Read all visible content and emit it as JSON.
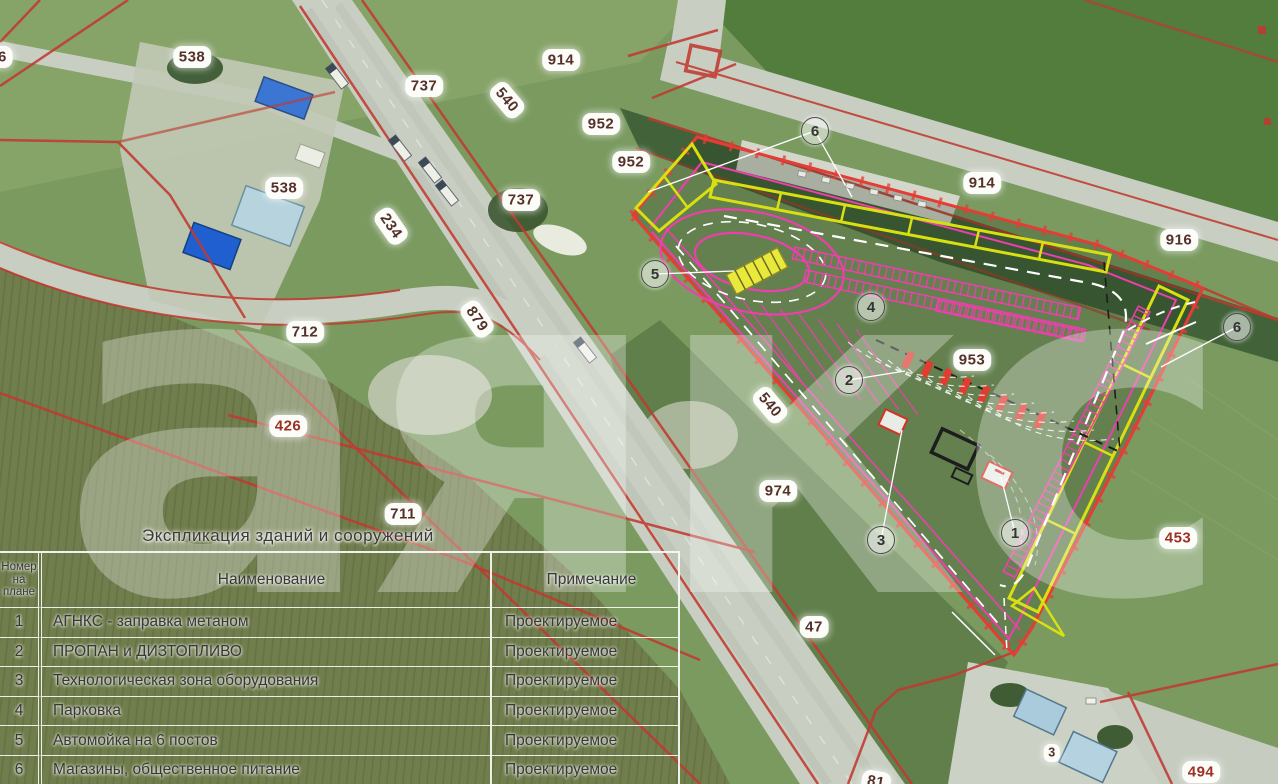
{
  "watermark": "аякс",
  "legend": {
    "title": "Экспликация зданий и сооружений",
    "columns": [
      "Номер на плане",
      "Наименование",
      "Примечание"
    ],
    "rows": [
      {
        "num": "1",
        "name": "АГНКС - заправка метаном",
        "note": "Проектируемое"
      },
      {
        "num": "2",
        "name": "ПРОПАН и ДИЗТОПЛИВО",
        "note": "Проектируемое"
      },
      {
        "num": "3",
        "name": "Технологическая зона оборудования",
        "note": "Проектируемое"
      },
      {
        "num": "4",
        "name": "Парковка",
        "note": "Проектируемое"
      },
      {
        "num": "5",
        "name": "Автомойка на 6 постов",
        "note": "Проектируемое"
      },
      {
        "num": "6",
        "name": "Магазины, общественное питание",
        "note": "Проектируемое"
      }
    ]
  },
  "map": {
    "parcel_labels": [
      {
        "text": "76",
        "x": -2,
        "y": 57,
        "rot": 0
      },
      {
        "text": "538",
        "x": 192,
        "y": 57,
        "rot": 0
      },
      {
        "text": "538",
        "x": 284,
        "y": 188,
        "rot": 0
      },
      {
        "text": "737",
        "x": 424,
        "y": 86,
        "rot": 0
      },
      {
        "text": "540",
        "x": 507,
        "y": 100,
        "rot": 50
      },
      {
        "text": "914",
        "x": 561,
        "y": 60,
        "rot": 0
      },
      {
        "text": "952",
        "x": 601,
        "y": 124,
        "rot": 0
      },
      {
        "text": "952",
        "x": 631,
        "y": 162,
        "rot": 0
      },
      {
        "text": "737",
        "x": 521,
        "y": 200,
        "rot": 0
      },
      {
        "text": "234",
        "x": 391,
        "y": 226,
        "rot": 55
      },
      {
        "text": "879",
        "x": 477,
        "y": 319,
        "rot": 55
      },
      {
        "text": "712",
        "x": 305,
        "y": 332,
        "rot": 0
      },
      {
        "text": "426",
        "x": 288,
        "y": 426,
        "rot": 0,
        "red": true
      },
      {
        "text": "711",
        "x": 403,
        "y": 514,
        "rot": 0
      },
      {
        "text": "540",
        "x": 770,
        "y": 405,
        "rot": 50
      },
      {
        "text": "974",
        "x": 778,
        "y": 491,
        "rot": 0
      },
      {
        "text": "914",
        "x": 982,
        "y": 183,
        "rot": 0
      },
      {
        "text": "916",
        "x": 1179,
        "y": 240,
        "rot": 0
      },
      {
        "text": "953",
        "x": 972,
        "y": 360,
        "rot": 0
      },
      {
        "text": "453",
        "x": 1178,
        "y": 538,
        "rot": 0,
        "red": true
      },
      {
        "text": "47",
        "x": 814,
        "y": 627,
        "rot": 0
      },
      {
        "text": "494",
        "x": 1201,
        "y": 772,
        "rot": 0,
        "red": true
      },
      {
        "text": "81",
        "x": 876,
        "y": 782,
        "rot": 10
      },
      {
        "text": "3",
        "x": 1052,
        "y": 753,
        "rot": 0,
        "small": true
      }
    ],
    "callouts": [
      {
        "num": "6",
        "x": 815,
        "y": 131
      },
      {
        "num": "5",
        "x": 655,
        "y": 274
      },
      {
        "num": "4",
        "x": 871,
        "y": 307
      },
      {
        "num": "2",
        "x": 849,
        "y": 380
      },
      {
        "num": "3",
        "x": 881,
        "y": 540
      },
      {
        "num": "1",
        "x": 1015,
        "y": 533
      },
      {
        "num": "6",
        "x": 1237,
        "y": 327
      }
    ]
  },
  "colors": {
    "site_boundary": "#e63c36",
    "site_buildings_outline": "#d9e012",
    "site_parking": "#ee3fae",
    "cadastral_line": "#c13a30",
    "label_text": "#55312b"
  }
}
